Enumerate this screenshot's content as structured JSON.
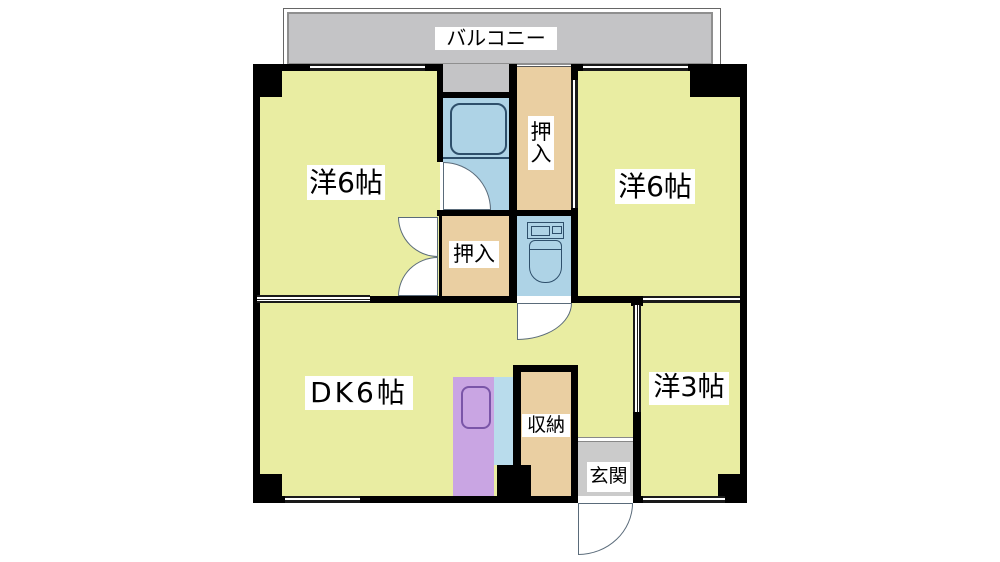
{
  "labels": {
    "balcony": "バルコニー",
    "room_left": "洋6帖",
    "room_right": "洋6帖",
    "closet_upper": "押入",
    "closet_lower": "押入",
    "dk": "DK6帖",
    "storage": "収納",
    "entrance": "玄関",
    "room_small": "洋3帖"
  },
  "rooms": [
    {
      "name": "balcony",
      "label": "バルコニー"
    },
    {
      "name": "western-room-northwest",
      "label": "洋6帖",
      "tatami": 6
    },
    {
      "name": "western-room-northeast",
      "label": "洋6帖",
      "tatami": 6
    },
    {
      "name": "closet-upper",
      "label": "押入"
    },
    {
      "name": "closet-lower",
      "label": "押入"
    },
    {
      "name": "dining-kitchen",
      "label": "DK6帖",
      "tatami": 6
    },
    {
      "name": "storage",
      "label": "収納"
    },
    {
      "name": "entrance",
      "label": "玄関"
    },
    {
      "name": "western-room-southeast",
      "label": "洋3帖",
      "tatami": 3
    }
  ],
  "colors": {
    "wall": "#000000",
    "room-yellow": "#e9eda2",
    "closet-tan": "#eacfa2",
    "water-blue": "#aed3e6",
    "counter-blue": "#b9dcec",
    "kitchen-purple": "#c9a5e3",
    "balcony": "#c4c4c6",
    "genkan-gray": "#cbcbcb",
    "fixture-line": "#2e4f6b"
  }
}
